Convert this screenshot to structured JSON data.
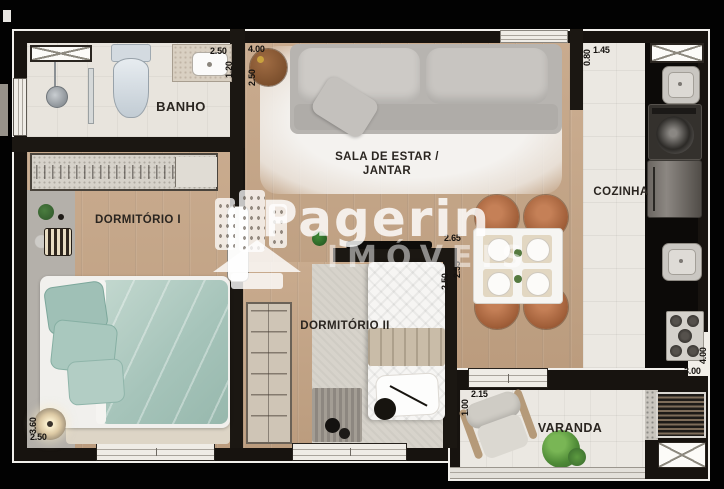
{
  "watermark": {
    "brand": "Pagerin",
    "subtitle": "IMÓVEIS"
  },
  "rooms": {
    "banho": {
      "label": "BANHO"
    },
    "sala": {
      "label1": "SALA DE ESTAR /",
      "label2": "JANTAR"
    },
    "cozinha": {
      "label": "COZINHA"
    },
    "dormitorio1": {
      "label": "DORMITÓRIO I"
    },
    "dormitorio2": {
      "label": "DORMITÓRIO II"
    },
    "varanda": {
      "label": "VARANDA"
    }
  },
  "measurements": {
    "banho_width": "2.50",
    "banho_depth": "1.20",
    "sala_width": "4.00",
    "sala_depth": "2.50",
    "cozinha_entry_depth": "0.80",
    "cozinha_entry_width": "1.45",
    "dormitorio2_width": "2.65",
    "dormitorio2_depth": "2.50",
    "dining_depth": "2.55",
    "dormitorio1_depth": "3.60",
    "dormitorio1_width": "2.50",
    "cozinha_width": "3.00",
    "cozinha_depth": "4.00",
    "varanda_width": "2.15",
    "varanda_depth": "1.00"
  },
  "colors": {
    "background": "#000000",
    "wall": "#1b1712",
    "wood_floor": "#c3a486",
    "tile_floor": "#ebe8e2",
    "bed_teal": "#a9c7bd",
    "watermark_white": "#ffffff"
  }
}
